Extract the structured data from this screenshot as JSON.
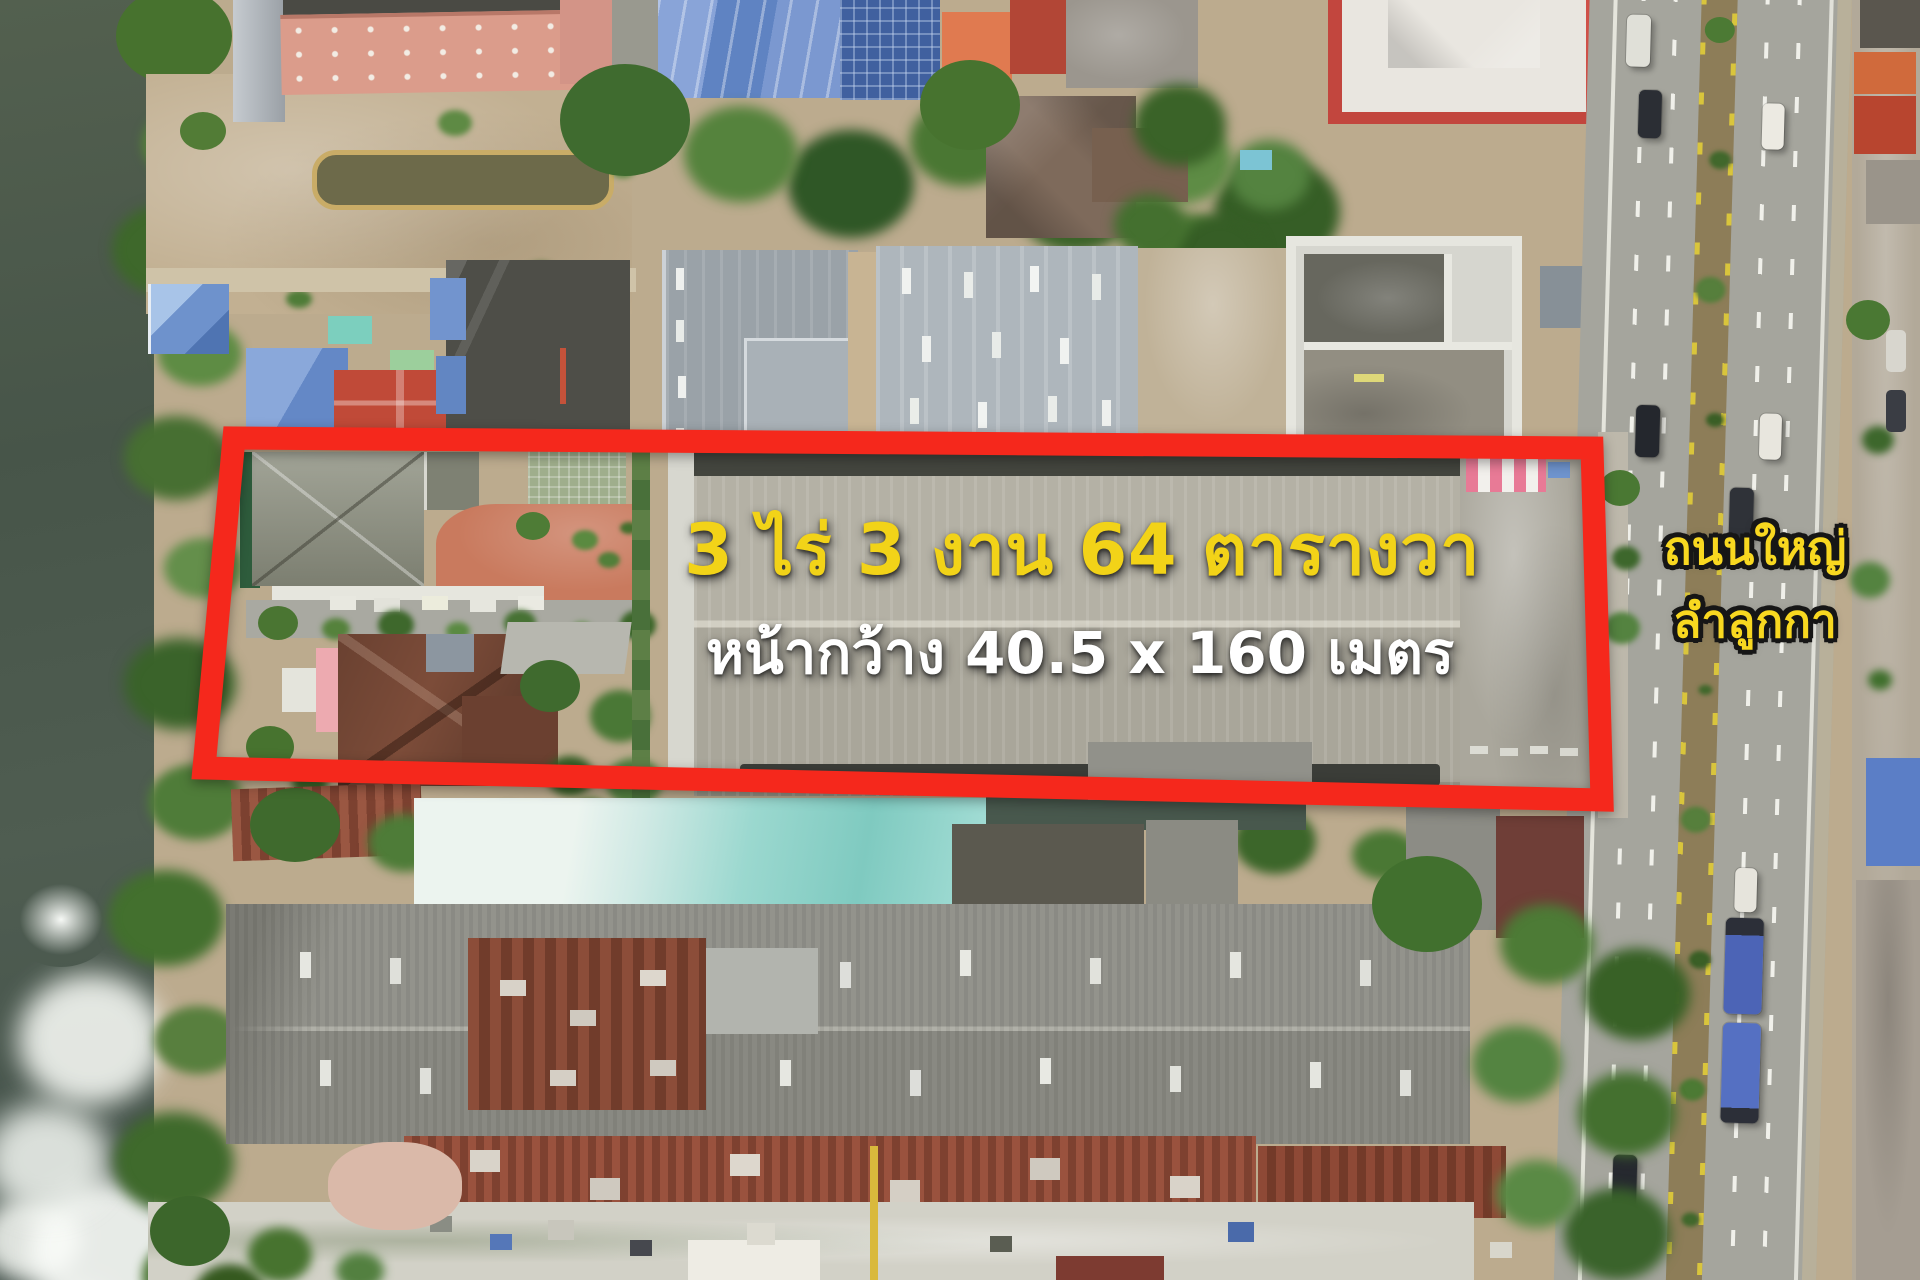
{
  "annotations": {
    "area": "3 ไร่ 3 งาน 64 ตารางวา",
    "frontage": "หน้ากว้าง 40.5 x 160 เมตร",
    "road_line1": "ถนนใหญ่",
    "road_line2": "ลำลูกกา"
  },
  "colors": {
    "boundary_outline": "#f5281c",
    "area_text": "#f2d318",
    "frontage_text": "#ffffff",
    "road_text_fill": "#f8d820",
    "road_text_outline": "#161616"
  }
}
